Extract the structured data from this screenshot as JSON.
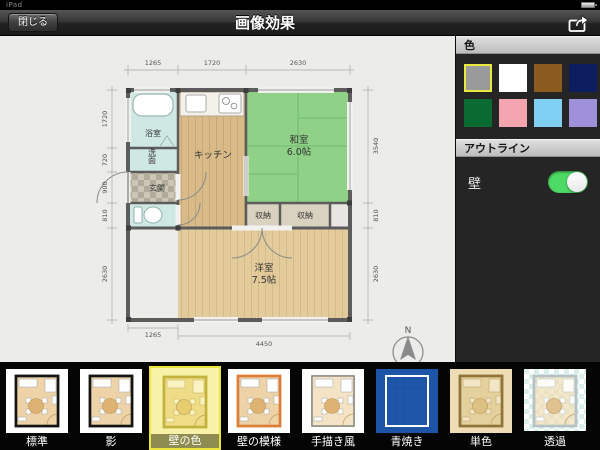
{
  "status_bar": {
    "left_text": "iPad"
  },
  "nav": {
    "close_label": "閉じる",
    "title": "画像効果"
  },
  "sidebar": {
    "color_header": "色",
    "swatches": [
      {
        "name": "gray",
        "hex": "#9a9a9a",
        "selected": true
      },
      {
        "name": "white",
        "hex": "#ffffff",
        "selected": false
      },
      {
        "name": "brown",
        "hex": "#8a5a1e",
        "selected": false
      },
      {
        "name": "navy",
        "hex": "#0d1e60",
        "selected": false
      },
      {
        "name": "green",
        "hex": "#0a6b32",
        "selected": false
      },
      {
        "name": "pink",
        "hex": "#f3a4ae",
        "selected": false
      },
      {
        "name": "light-blue",
        "hex": "#7fd0f2",
        "selected": false
      },
      {
        "name": "purple",
        "hex": "#9e90d9",
        "selected": false
      }
    ],
    "selected_border_color": "#e9e93f",
    "outline_header": "アウトライン",
    "wall_label": "壁",
    "wall_toggle_on": true,
    "toggle_on_color": "#4cd964"
  },
  "floorplan": {
    "rooms": {
      "bath": "浴室",
      "washroom": "洗面",
      "entrance": "玄関",
      "kitchen": "キッチン",
      "japanese_room": "和室",
      "japanese_room_size": "6.0帖",
      "closet1": "収納",
      "closet2": "収納",
      "western_room": "洋室",
      "western_room_size": "7.5帖"
    },
    "dimensions": {
      "top": [
        "1265",
        "1720",
        "2630"
      ],
      "left": [
        "1720",
        "720",
        "900",
        "810",
        "2630"
      ],
      "right": [
        "3540",
        "810",
        "2630"
      ],
      "bottom": [
        "1265",
        "4450"
      ]
    },
    "compass": "N",
    "colors": {
      "tatami_green": "#8fd287",
      "wood_floor": "#e4cb9b",
      "kitchen_floor": "#d9bb8a",
      "water_rooms": "#cfe8e3"
    }
  },
  "effects": {
    "items": [
      {
        "label": "標準",
        "selected": false
      },
      {
        "label": "影",
        "selected": false
      },
      {
        "label": "壁の色",
        "selected": true
      },
      {
        "label": "壁の模様",
        "selected": false
      },
      {
        "label": "手描き風",
        "selected": false
      },
      {
        "label": "青焼き",
        "selected": false
      },
      {
        "label": "単色",
        "selected": false
      },
      {
        "label": "透過",
        "selected": false
      }
    ]
  }
}
